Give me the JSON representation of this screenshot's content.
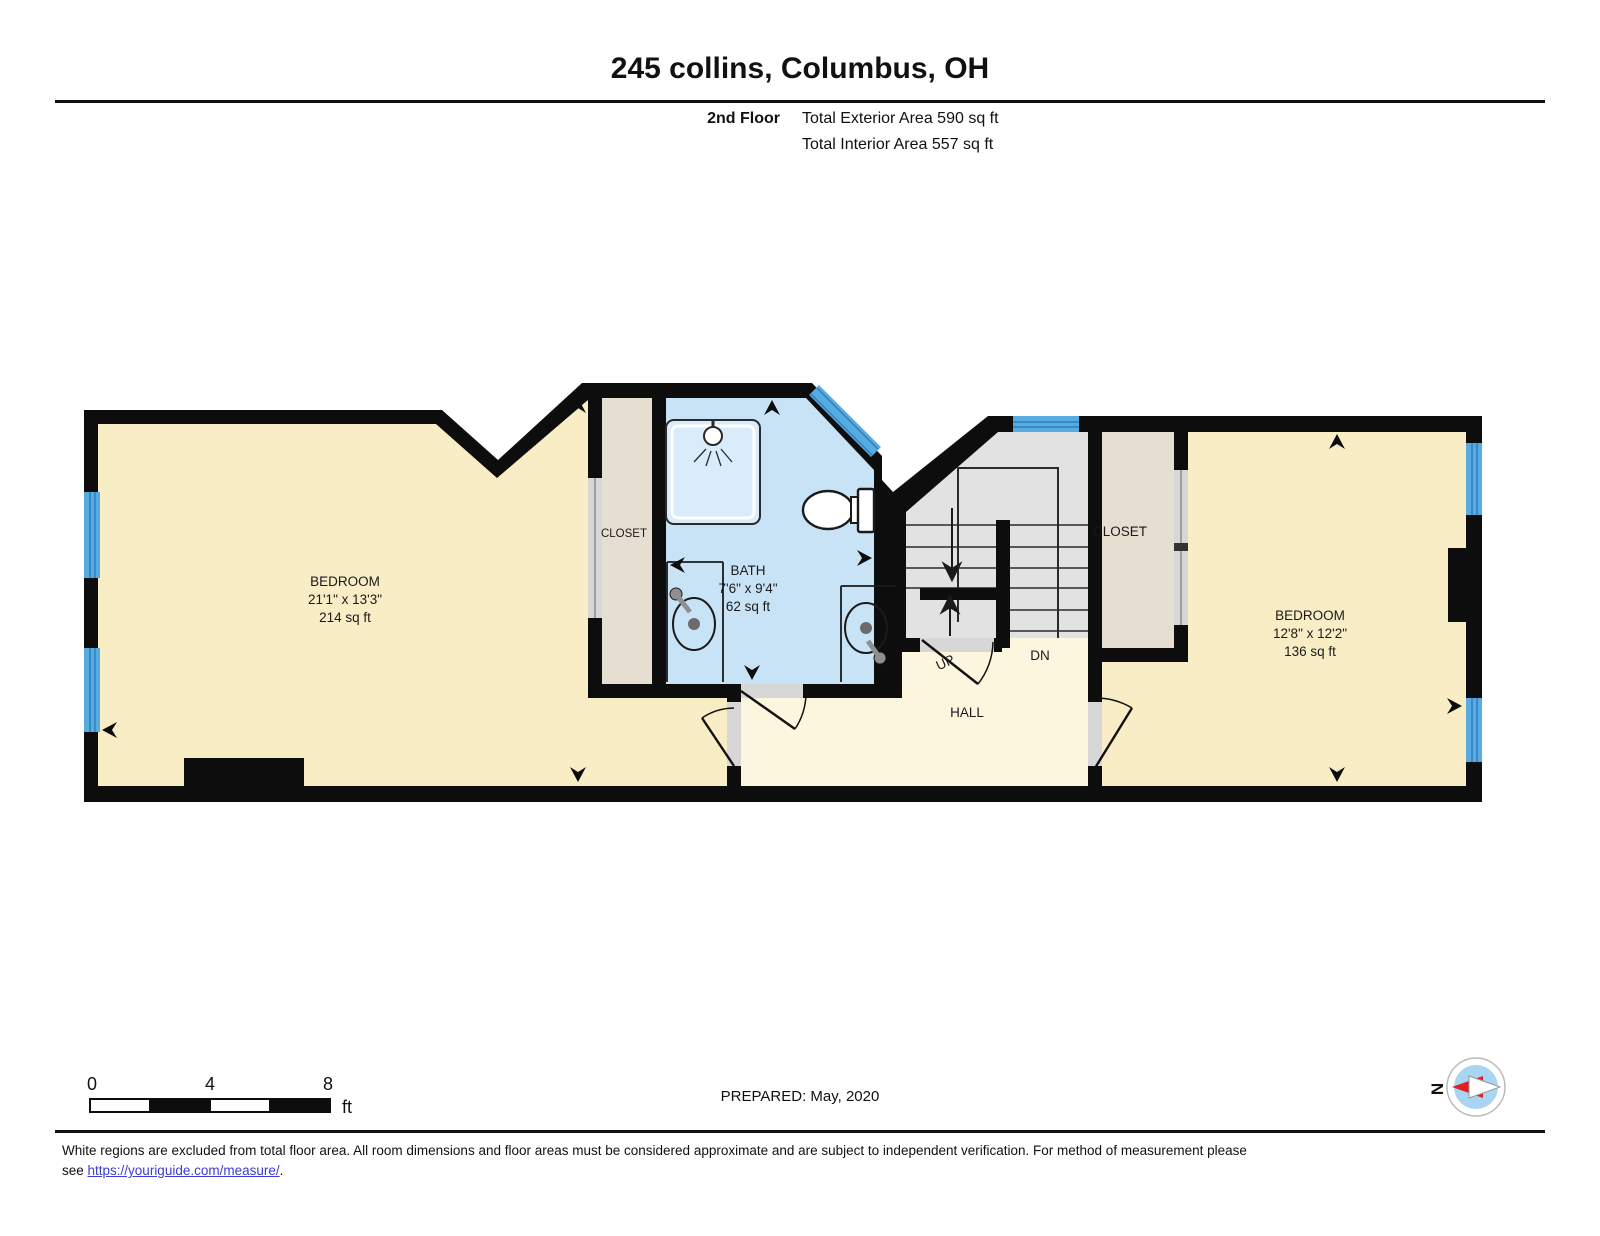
{
  "header": {
    "title": "245 collins, Columbus, OH",
    "floor_label": "2nd Floor",
    "total_exterior": "Total Exterior Area 590 sq ft",
    "total_interior": "Total Interior Area 557 sq ft"
  },
  "rooms": {
    "bedroom1": {
      "name": "BEDROOM",
      "dims": "21'1\" x 13'3\"",
      "area": "214 sq ft"
    },
    "bath": {
      "name": "BATH",
      "dims": "7'6\" x 9'4\"",
      "area": "62 sq ft"
    },
    "bedroom2": {
      "name": "BEDROOM",
      "dims": "12'8\" x 12'2\"",
      "area": "136 sq ft"
    },
    "closet_left": {
      "name": "CLOSET"
    },
    "closet_right": {
      "name": "CLOSET"
    },
    "hall": {
      "name": "HALL"
    },
    "stairs": {
      "up": "UP",
      "down": "DN"
    }
  },
  "scale_bar": {
    "tick0": "0",
    "tick4": "4",
    "tick8": "8",
    "unit": "ft"
  },
  "prepared": "PREPARED: May, 2020",
  "compass": {
    "north": "N"
  },
  "footer": {
    "line1": "White regions are excluded from total floor area. All room dimensions and floor areas must be considered approximate and are subject to independent verification. For method of measurement please",
    "see": "see ",
    "link": "https://youriguide.com/measure/",
    "period": "."
  },
  "colors": {
    "wall": "#0d0d0d",
    "bedroom_fill": "#f9edc6",
    "hall_fill": "#fdf6df",
    "bath_fill": "#c9e3f6",
    "stairs_fill": "#e2e2e2",
    "closet_fill": "#e6dfd1",
    "window_blue": "#57abe0",
    "window_line": "#2e7fbe",
    "door_gray": "#d7d7d7",
    "compass_inner": "#a8d5f2",
    "compass_red": "#e02020",
    "link_blue": "#3b3bd6"
  }
}
